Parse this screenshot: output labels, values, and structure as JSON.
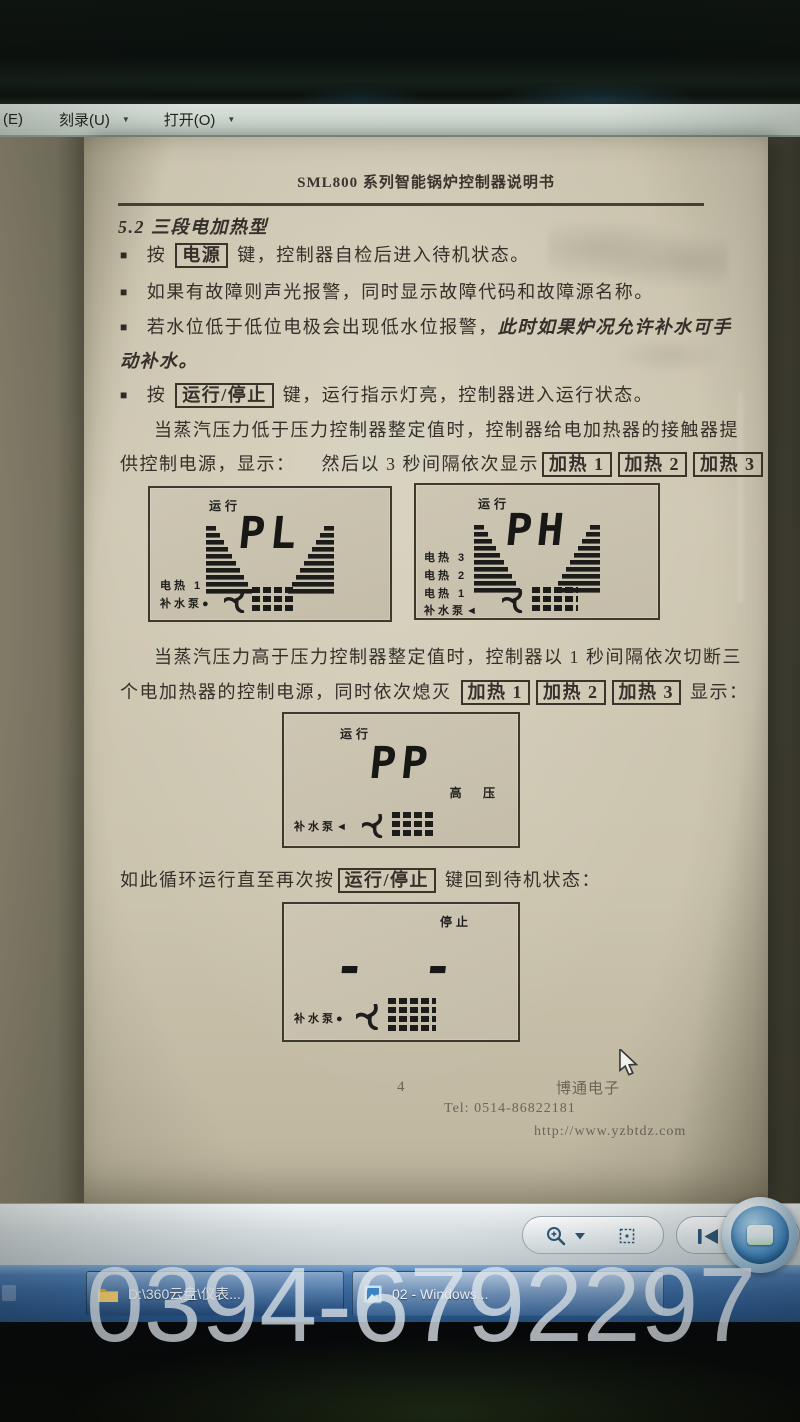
{
  "menu": {
    "partial": "(E)",
    "burn": "刻录(U)",
    "open": "打开(O)",
    "caret": "▼"
  },
  "doc": {
    "header_title": "SML800 系列智能锅炉控制器说明书",
    "section_title": "5.2 三段电加热型",
    "bullet_char": "■",
    "b1_pre": "按 ",
    "b1_key": "电源",
    "b1_post": " 键，控制器自检后进入待机状态。",
    "b2": "如果有故障则声光报警，同时显示故障代码和故障源名称。",
    "b3_pre": "若水位低于低位电极会出现低水位报警，",
    "b3_em": "此时如果炉况允许补水可手",
    "b3_em2": "动补水。",
    "b4_pre": "按 ",
    "b4_key": "运行/停止",
    "b4_post": " 键，运行指示灯亮，控制器进入运行状态。",
    "p1_line1": "当蒸汽压力低于压力控制器整定值时，控制器给电加热器的接触器提",
    "p1_line2_pre": "供控制电源，显示：",
    "p1_line2_mid": "然后以 3 秒间隔依次显示",
    "heat_keys": [
      "加热 1",
      "加热 2",
      "加热 3"
    ],
    "p2_line1": "当蒸汽压力高于压力控制器整定值时，控制器以 1 秒间隔依次切断三",
    "p2_line2_pre": "个电加热器的控制电源，同时依次熄灭 ",
    "p2_line2_post": " 显示：",
    "loop_pre": "如此循环运行直至再次按",
    "loop_key": "运行/停止",
    "loop_post": " 键回到待机状态：",
    "displays": [
      {
        "status": "运行",
        "value": "PL",
        "labels": [
          "电热 1",
          "补水泵●"
        ]
      },
      {
        "status": "运行",
        "value": "PH",
        "labels": [
          "电热 3",
          "电热 2",
          "电热 1",
          "补水泵◄"
        ]
      },
      {
        "status": "运行",
        "value": "PP",
        "right_label": "高  压",
        "labels": [
          "补水泵◄"
        ]
      },
      {
        "status": "停止",
        "value": "- -",
        "labels": [
          "补水泵●"
        ]
      }
    ],
    "footer_page": "4",
    "footer_company": "博通电子",
    "footer_tel": "Tel: 0514-86822181",
    "footer_url": "http://www.yzbtdz.com"
  },
  "taskbar": {
    "window1": "D:\\360云盘\\仪表...",
    "window2": "02 - Windows..."
  },
  "watermark": "0394-6792297"
}
